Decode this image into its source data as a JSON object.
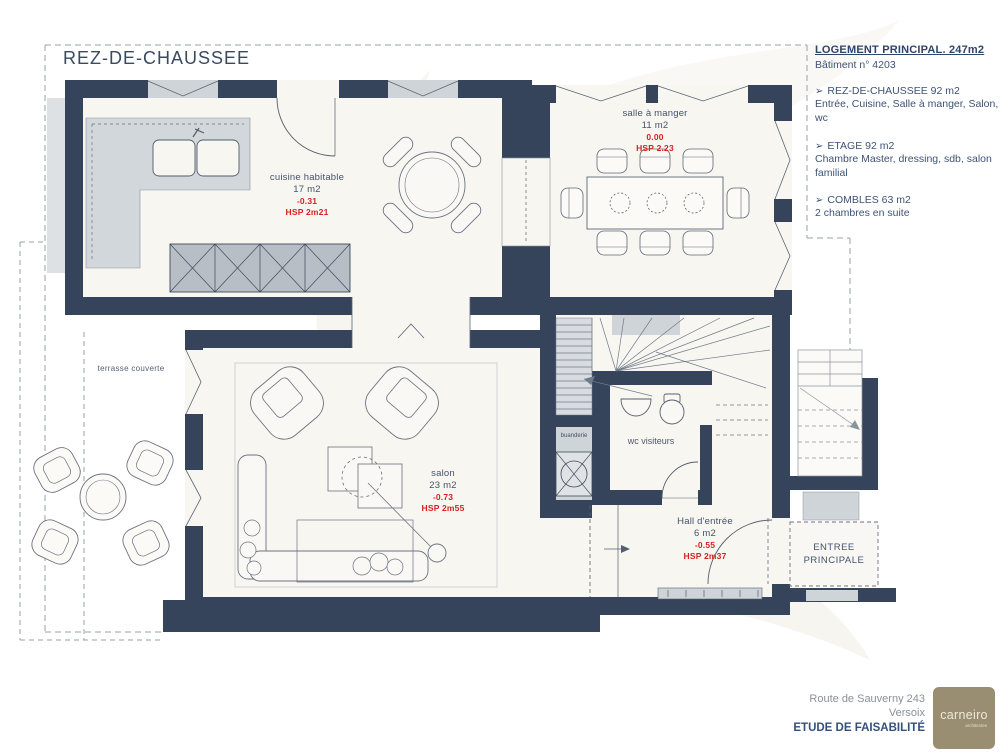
{
  "title": "REZ-DE-CHAUSSEE",
  "info_panel": {
    "heading": "LOGEMENT PRINCIPAL. 247m2",
    "building_no": "Bâtiment n° 4203",
    "sections": [
      {
        "bullet": "➢",
        "title": "REZ-DE-CHAUSSEE 92 m2",
        "desc": "Entrée, Cuisine, Salle à manger, Salon, wc"
      },
      {
        "bullet": "➢",
        "title": "ETAGE 92 m2",
        "desc": "Chambre Master, dressing, sdb, salon familial"
      },
      {
        "bullet": "➢",
        "title": "COMBLES 63 m2",
        "desc": "2 chambres en suite"
      }
    ]
  },
  "rooms": {
    "cuisine": {
      "name": "cuisine habitable",
      "area": "17 m2",
      "level": "-0.31",
      "hsp": "HSP 2m21"
    },
    "salle_a_manger": {
      "name": "salle à manger",
      "area": "11 m2",
      "level": "0.00",
      "hsp": "HSP 2.23"
    },
    "salon": {
      "name": "salon",
      "area": "23 m2",
      "level": "-0.73",
      "hsp": "HSP 2m55"
    },
    "hall": {
      "name": "Hall d'entrée",
      "area": "6 m2",
      "level": "-0.55",
      "hsp": "HSP 2m37"
    },
    "wc": {
      "name": "wc visiteurs"
    },
    "buanderie": {
      "name": "buanderie"
    },
    "terrasse": {
      "name": "terrasse couverte"
    },
    "entree_principale": {
      "line1": "ENTREE",
      "line2": "PRINCIPALE"
    }
  },
  "footer": {
    "address_line1": "Route de Sauverny 243",
    "address_line2": "Versoix",
    "doc_type": "ETUDE DE FAISABILITÉ",
    "logo_text": "carneiro",
    "logo_subtext": "architectes"
  },
  "colors": {
    "wall": "#35445a",
    "floor": "#f7f6f1",
    "accent_red": "#d42222",
    "text_navy": "#3f5170",
    "logo_taupe": "#998d72"
  }
}
